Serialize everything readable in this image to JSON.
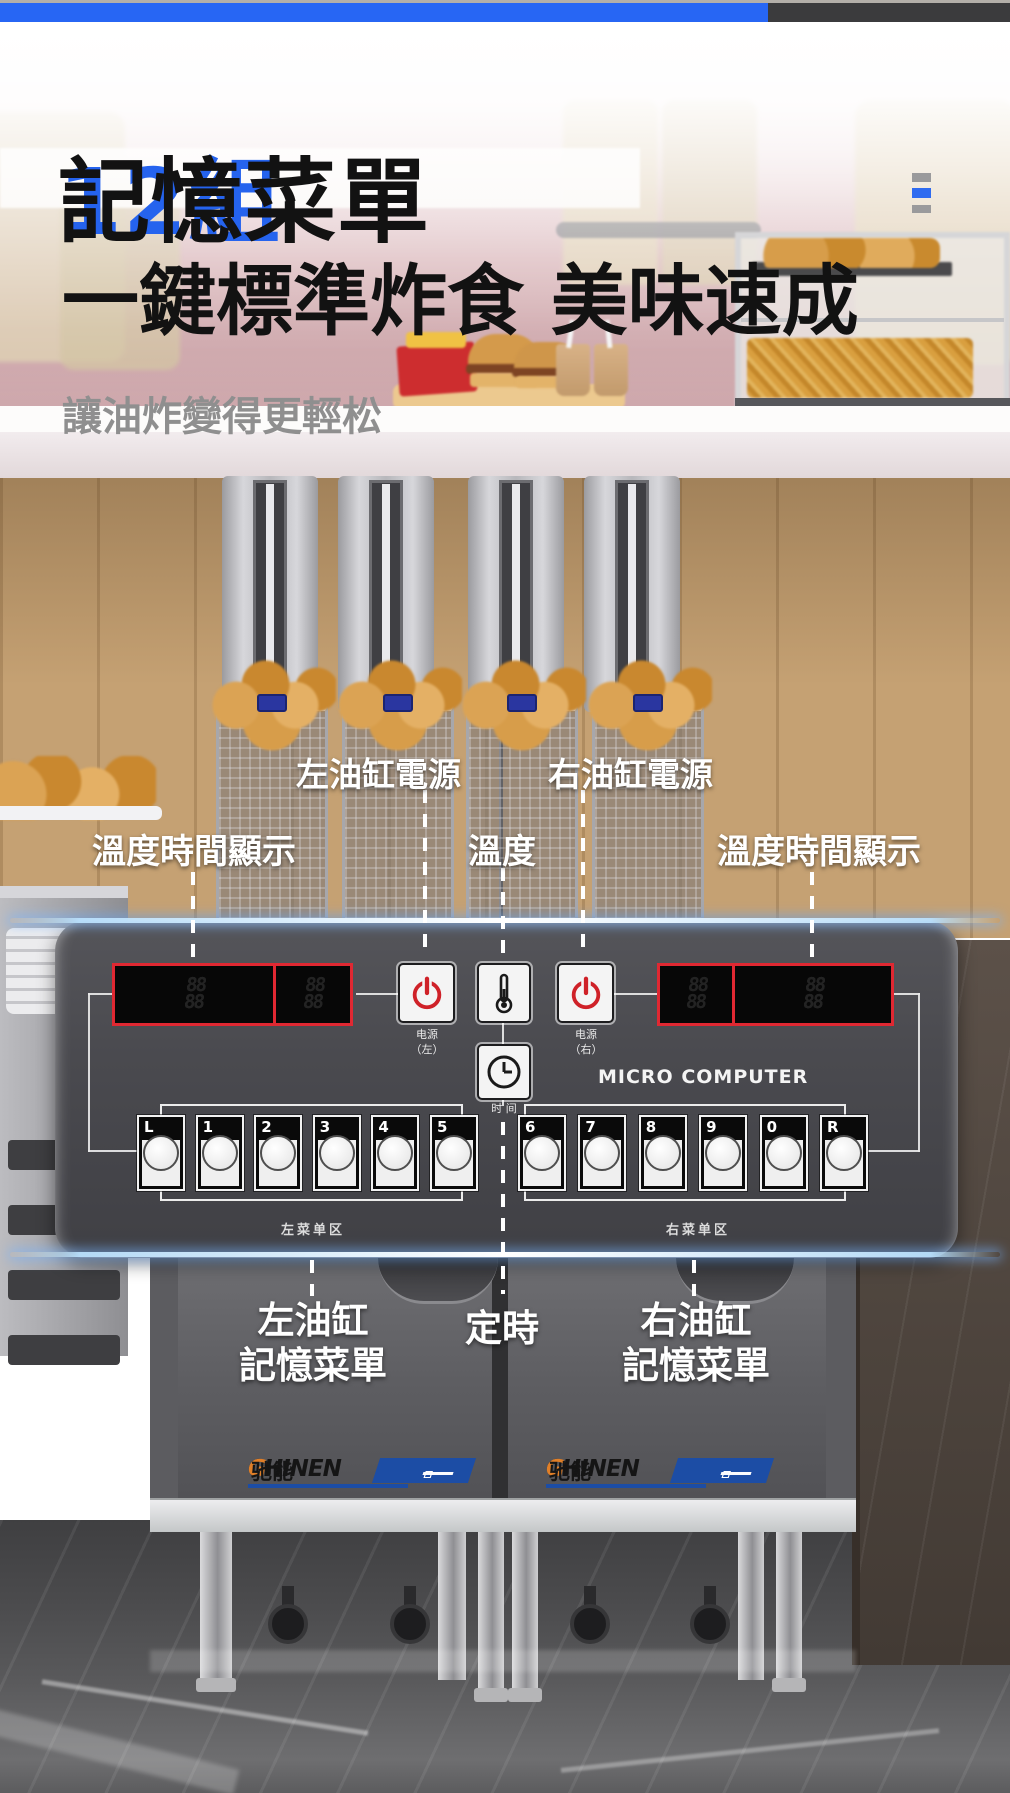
{
  "topbar": {
    "blue_color": "#2766f4",
    "dark_color": "#3b3b3d"
  },
  "hero": {
    "title_highlight": "12組",
    "title_rest": "記憶菜單",
    "subtitle": "一鍵標準炸食 美味速成",
    "tagline": "讓油炸變得更輕松"
  },
  "callouts": {
    "power_left": "左油缸電源",
    "power_right": "右油缸電源",
    "display_left": "溫度時間顯示",
    "temperature": "溫度",
    "display_right": "溫度時間顯示",
    "menu_left_line1": "左油缸",
    "menu_left_line2": "記憶菜單",
    "timer": "定時",
    "menu_right_line1": "右油缸",
    "menu_right_line2": "記憶菜單"
  },
  "panel": {
    "power_label": "电源",
    "power_left_sub": "（左）",
    "power_right_sub": "（右）",
    "time_label": "时 间",
    "micro_computer": "MICRO COMPUTER",
    "zone_left": "左菜单区",
    "zone_right": "右菜单区",
    "buttons_left": [
      "L",
      "1",
      "2",
      "3",
      "4",
      "5"
    ],
    "buttons_right": [
      "6",
      "7",
      "8",
      "9",
      "0",
      "R"
    ],
    "display_cell": "88\n88"
  },
  "brand": {
    "en_head": "CHINEN",
    "en_tail": "G",
    "cn": "驰能"
  },
  "colors": {
    "accent_blue": "#2563ee",
    "display_border_red": "#e02832",
    "power_icon_red": "#cf2128",
    "ribbon_blue": "#1c4da5",
    "logo_orange": "#e07f28"
  }
}
